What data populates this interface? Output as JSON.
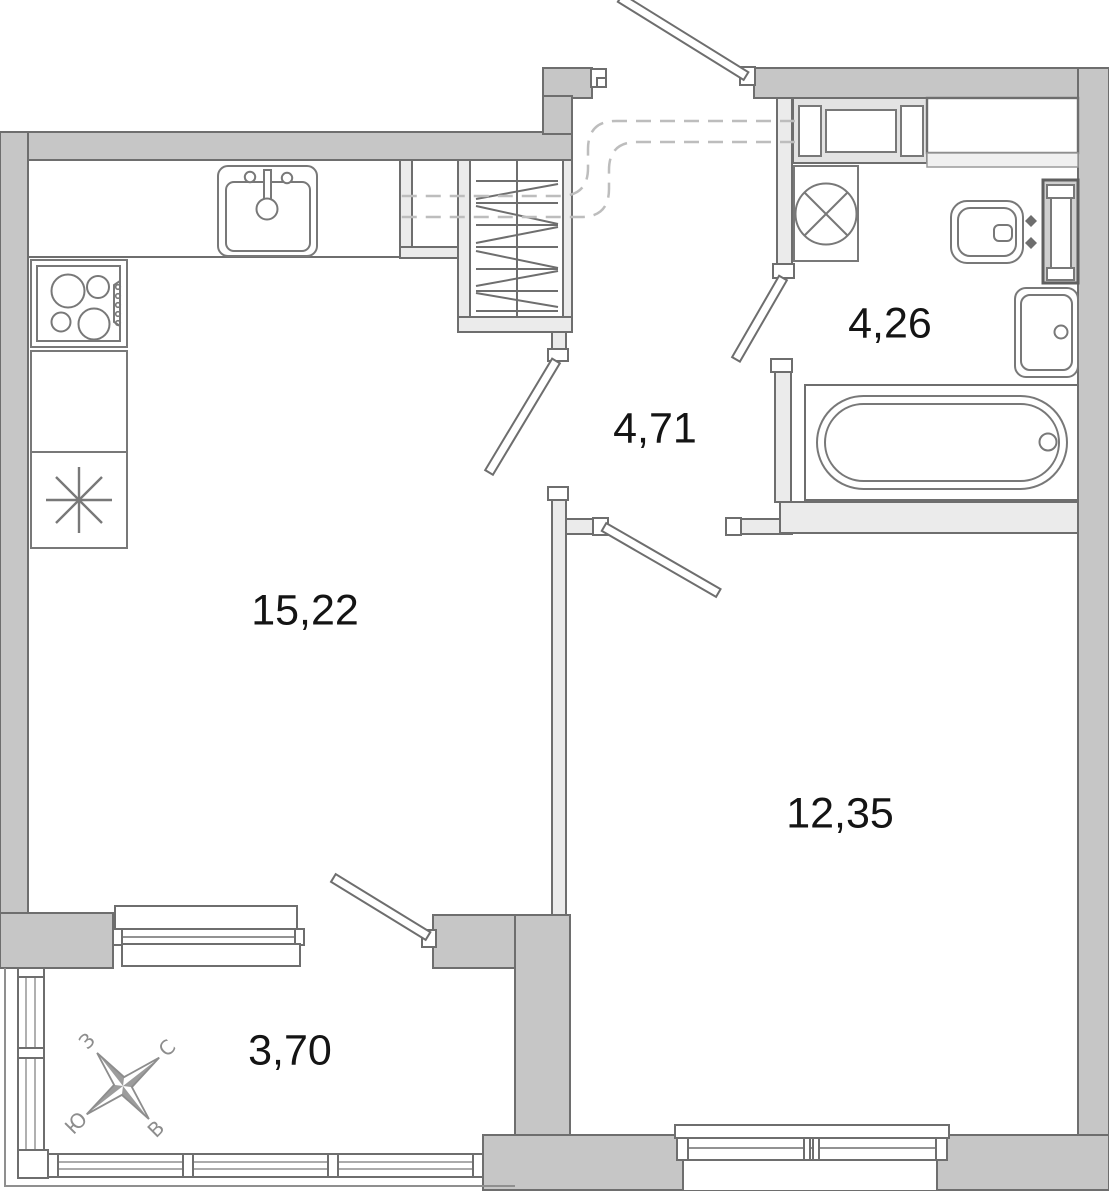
{
  "plan": {
    "type": "apartment-floor-plan",
    "units": "square-meters-with-comma-decimal"
  },
  "rooms": [
    {
      "name": "kitchen-living-room",
      "area": "15,22"
    },
    {
      "name": "hallway",
      "area": "4,71"
    },
    {
      "name": "bathroom",
      "area": "4,26"
    },
    {
      "name": "bedroom",
      "area": "12,35"
    },
    {
      "name": "balcony",
      "area": "3,70"
    }
  ],
  "compass": {
    "north": "С",
    "south": "Ю",
    "west": "З",
    "east": "В"
  },
  "fixtures": [
    "kitchen-sink",
    "stove",
    "kitchen-cabinet",
    "fridge",
    "wardrobe",
    "vent-niche",
    "vent-shaft",
    "washing-machine",
    "toilet",
    "towel-radiator",
    "bathroom-sink",
    "bathtub"
  ],
  "colors": {
    "outer_wall_fill": "#c6c6c6",
    "wall_outline": "#6e6e6e",
    "partition_fill": "#ebebeb",
    "duct_dash": "#bdbdbd",
    "label_text": "#141414",
    "compass_gray": "#8d8d8d",
    "background": "#ffffff"
  }
}
